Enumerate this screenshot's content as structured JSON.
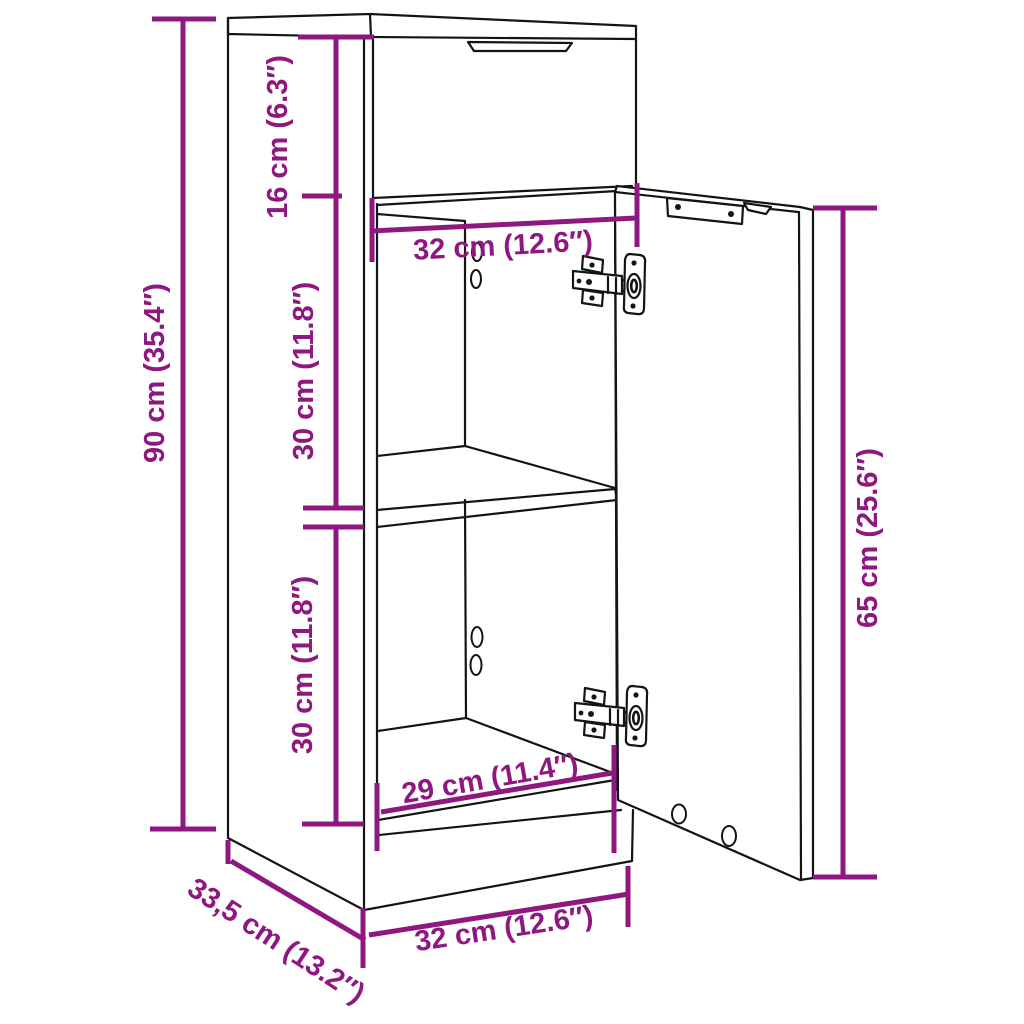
{
  "diagram": {
    "type": "furniture-dimension-diagram",
    "subject": "narrow cabinet with top drawer and open door",
    "colors": {
      "accent": "#8E1880",
      "line": "#141414",
      "background": "#FFFFFF"
    },
    "dimensions": {
      "overall_height": "90 cm (35.4″)",
      "drawer_height": "16 cm (6.3″)",
      "inner_width_top": "32 cm (12.6″)",
      "upper_compartment_height": "30 cm (11.8″)",
      "lower_compartment_height": "30 cm (11.8″)",
      "door_height": "65 cm (25.6″)",
      "inner_width_bottom": "29 cm (11.4″)",
      "depth": "33,5 cm (13.2″)",
      "overall_width": "32 cm (12.6″)"
    }
  }
}
